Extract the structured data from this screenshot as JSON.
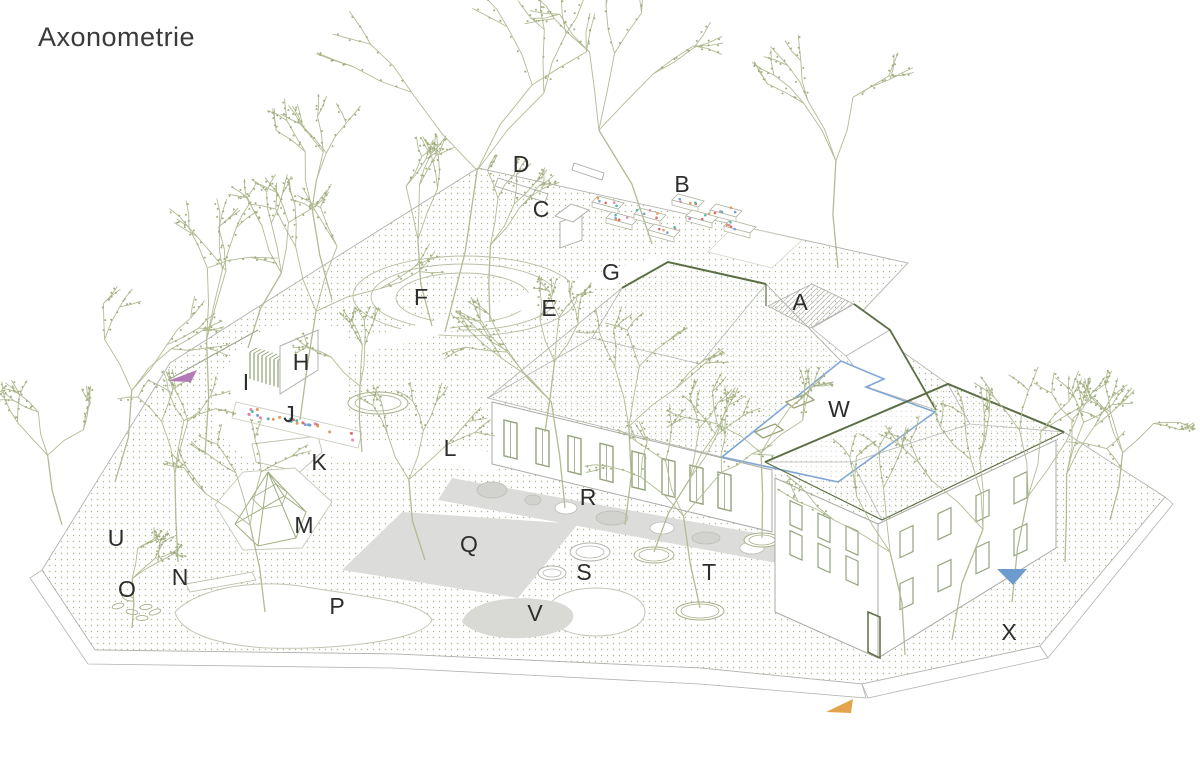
{
  "title": "Axonometrie",
  "site_labels": [
    {
      "letter": "A",
      "x": 800,
      "y": 302
    },
    {
      "letter": "B",
      "x": 682,
      "y": 184
    },
    {
      "letter": "C",
      "x": 541,
      "y": 209
    },
    {
      "letter": "D",
      "x": 521,
      "y": 164
    },
    {
      "letter": "E",
      "x": 549,
      "y": 308
    },
    {
      "letter": "F",
      "x": 421,
      "y": 297
    },
    {
      "letter": "G",
      "x": 611,
      "y": 272
    },
    {
      "letter": "H",
      "x": 301,
      "y": 362
    },
    {
      "letter": "I",
      "x": 246,
      "y": 382
    },
    {
      "letter": "J",
      "x": 289,
      "y": 414
    },
    {
      "letter": "K",
      "x": 319,
      "y": 462
    },
    {
      "letter": "L",
      "x": 450,
      "y": 448
    },
    {
      "letter": "M",
      "x": 304,
      "y": 525
    },
    {
      "letter": "N",
      "x": 180,
      "y": 577
    },
    {
      "letter": "O",
      "x": 127,
      "y": 589
    },
    {
      "letter": "P",
      "x": 337,
      "y": 606
    },
    {
      "letter": "Q",
      "x": 469,
      "y": 544
    },
    {
      "letter": "R",
      "x": 588,
      "y": 497
    },
    {
      "letter": "S",
      "x": 584,
      "y": 572
    },
    {
      "letter": "T",
      "x": 709,
      "y": 572
    },
    {
      "letter": "U",
      "x": 116,
      "y": 538
    },
    {
      "letter": "V",
      "x": 535,
      "y": 613
    },
    {
      "letter": "W",
      "x": 839,
      "y": 409
    },
    {
      "letter": "X",
      "x": 1009,
      "y": 632
    }
  ],
  "markers": {
    "slide": {
      "color": "#b27ab6",
      "points": "168,381 197,370 191,382"
    },
    "entrance_secondary": {
      "color": "#6e9bcd",
      "points": "997,569 1027,569 1013,585"
    },
    "entrance_main": {
      "color": "#e4a34d",
      "points": "826,712 853,699 851,713"
    }
  },
  "palette": {
    "label_color": "#2d2d2d",
    "tree_line": "#b2bb93",
    "tree_bud": "#9fae7e",
    "ground_dot": "#a9b28c",
    "dark_olive": "#5c6e44",
    "line_gray": "#b2b2ae",
    "fill_gray": "#dcdcda",
    "window_frame": "#93a47e",
    "flat_roof_outline": "#7fa7d6",
    "flower_dots": [
      "#e09a5e",
      "#e08aae",
      "#57b9a9",
      "#d96a6a",
      "#7a9fd4"
    ]
  }
}
